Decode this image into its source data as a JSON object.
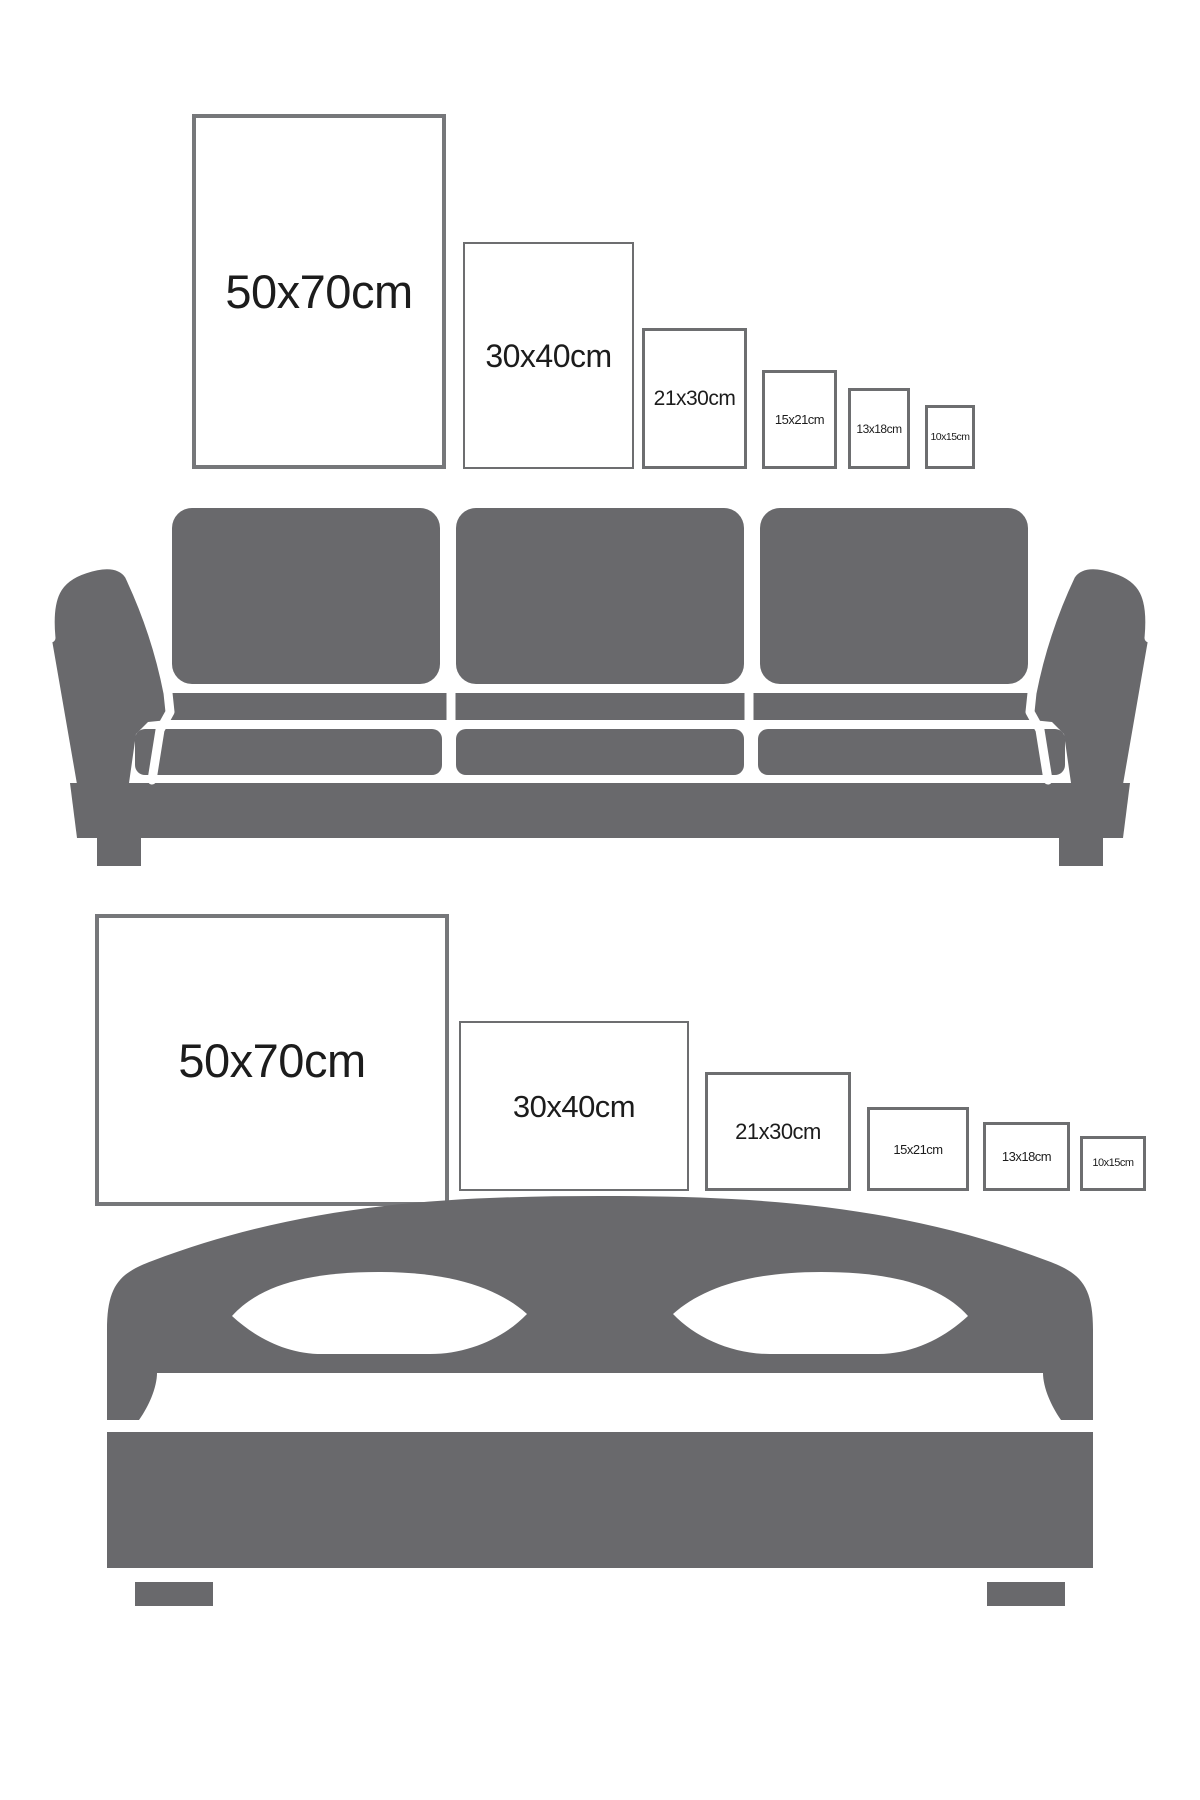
{
  "colors": {
    "background": "#ffffff",
    "furniture": "#69696c",
    "frame-border-large": "#76777a",
    "frame-border-small": "#6d6e70",
    "label-text": "#1c1c1c"
  },
  "sections": [
    {
      "furniture": "sofa",
      "frame_orientation": "portrait",
      "frames": [
        {
          "label": "50x70cm"
        },
        {
          "label": "30x40cm"
        },
        {
          "label": "21x30cm"
        },
        {
          "label": "15x21cm"
        },
        {
          "label": "13x18cm"
        },
        {
          "label": "10x15cm"
        }
      ]
    },
    {
      "furniture": "bed",
      "frame_orientation": "landscape",
      "frames": [
        {
          "label": "50x70cm"
        },
        {
          "label": "30x40cm"
        },
        {
          "label": "21x30cm"
        },
        {
          "label": "15x21cm"
        },
        {
          "label": "13x18cm"
        },
        {
          "label": "10x15cm"
        }
      ]
    }
  ]
}
